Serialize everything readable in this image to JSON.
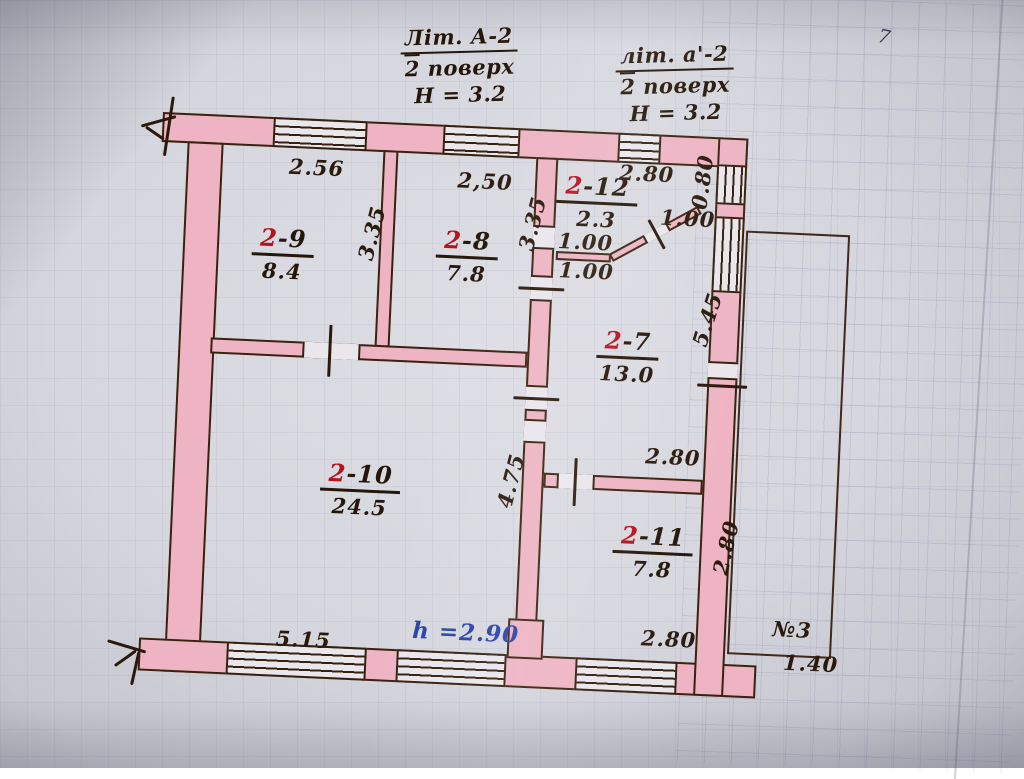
{
  "page": {
    "corner_mark": "7"
  },
  "titles": {
    "left": {
      "litera": "Літ. А-2",
      "floor_num": "2",
      "floor_word": "поверх",
      "height": "Н = 3.2"
    },
    "right": {
      "litera": "літ. а'-2",
      "floor_num": "2",
      "floor_word": "поверх",
      "height": "Н = 3.2"
    }
  },
  "rooms": [
    {
      "number_red": "2",
      "number_rest": "-9",
      "area": "8.4"
    },
    {
      "number_red": "2",
      "number_rest": "-8",
      "area": "7.8"
    },
    {
      "number_red": "2",
      "number_rest": "-12",
      "area": "2.3"
    },
    {
      "number_red": "2",
      "number_rest": "-7",
      "area": "13.0"
    },
    {
      "number_red": "2",
      "number_rest": "-10",
      "area": "24.5"
    },
    {
      "number_red": "2",
      "number_rest": "-11",
      "area": "7.8"
    }
  ],
  "dimensions": {
    "room9_width": "2.56",
    "room8_width": "2,50",
    "room9_depth": "3.35",
    "room8_depth": "3.35",
    "room12_width": "2.80",
    "room12_side": "0.80",
    "niche_upper": "1.00",
    "niche_lower": "1.00",
    "niche_diagonal": "1.00",
    "right_wall_length": "5.45",
    "hall_depth": "4.75",
    "room7_bottom_width": "2.80",
    "room11_depth": "2.80",
    "room11_width": "2.80",
    "room10_bottom_width": "5.15",
    "ceiling_height_note": "h =2.90",
    "porch_number": "№3",
    "porch_width": "1.40"
  },
  "colors": {
    "paper": "#d6d6de",
    "wall_fill": "#eeb4c3",
    "outline": "#39220f",
    "room_number_accent": "#b5121f",
    "height_note_blue": "#2742a8"
  }
}
